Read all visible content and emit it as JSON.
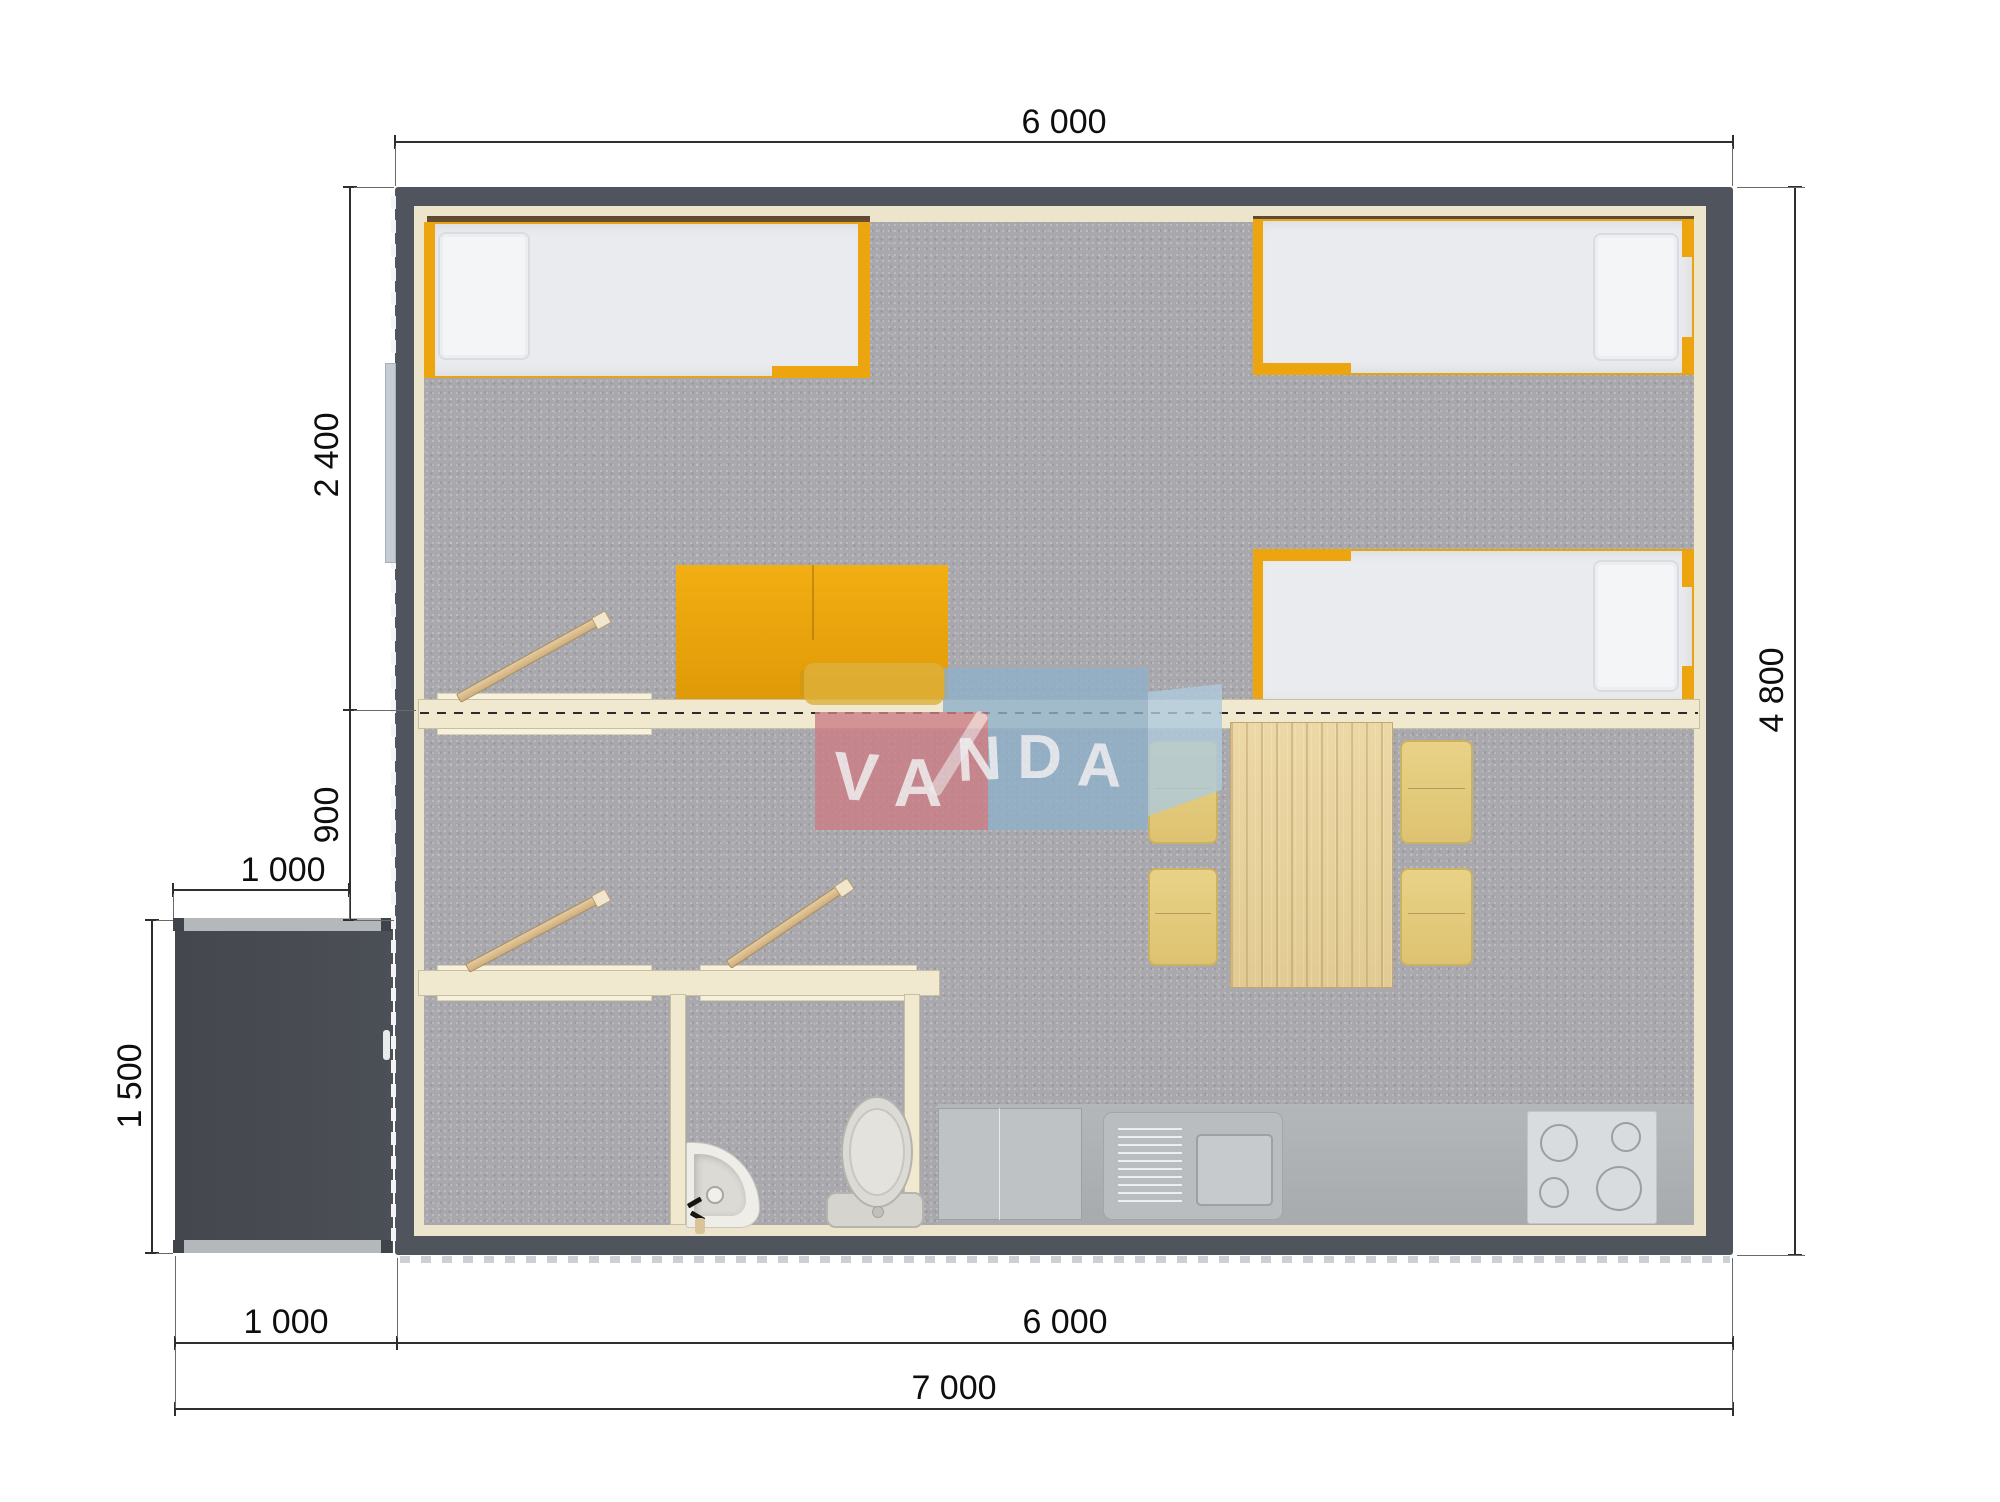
{
  "watermark": {
    "text": "VANDA"
  },
  "dimensions": {
    "top_width": "6 000",
    "bedroom_depth": "2 400",
    "hall_depth": "900",
    "porch_width": "1 000",
    "porch_depth": "1 500",
    "total_depth": "4 800",
    "bottom_porch_width": "1 000",
    "bottom_house_width": "6 000",
    "bottom_total_width": "7 000"
  },
  "colors": {
    "wall": "#50555d",
    "porch_floor": "#46494f",
    "carpet": "#a9a8ad",
    "interior_lining": "#ece5cc",
    "partition": "#f0e9d0",
    "accent_orange": "#eda50f",
    "wood": "#e2cb93",
    "chair": "#e3cd7e",
    "counter": "#adb1b4",
    "fixture_white": "#e9e7e2",
    "logo_yellow": "#ddb13c",
    "logo_pink": "#cd7d85",
    "logo_blue": "#8fb0ca",
    "dimension_text": "#0e0e0e"
  }
}
